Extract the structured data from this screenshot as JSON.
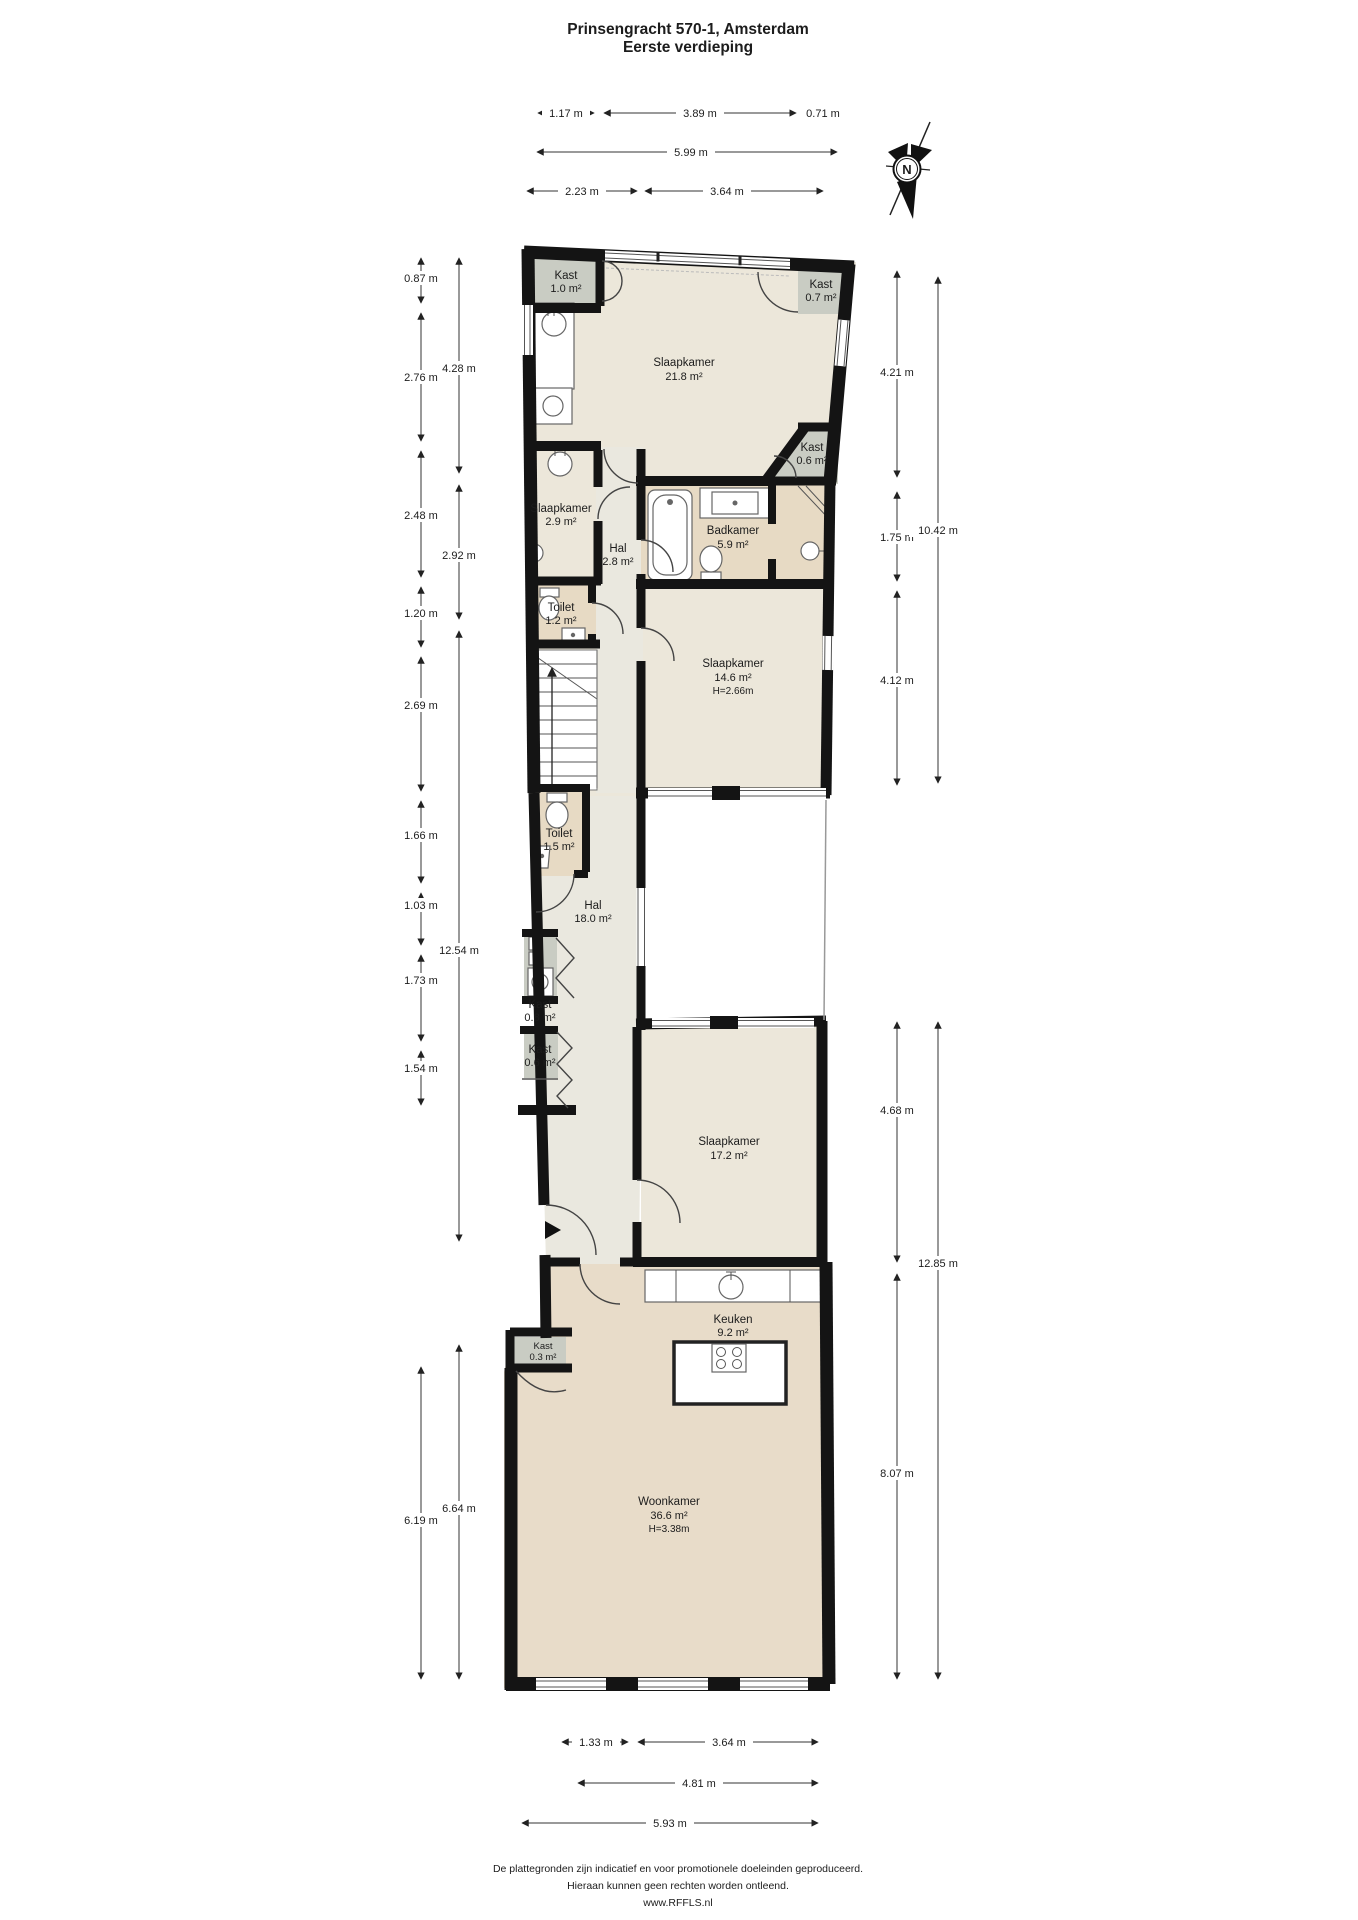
{
  "header": {
    "title_line1": "Prinsengracht 570-1, Amsterdam",
    "title_line2": "Eerste verdieping"
  },
  "compass": {
    "label": "N"
  },
  "rooms": [
    {
      "name": "Kast",
      "area": "1.0 m²"
    },
    {
      "name": "Slaapkamer",
      "area": "21.8 m²"
    },
    {
      "name": "Kast",
      "area": "0.7 m²"
    },
    {
      "name": "Kast",
      "area": "0.6 m²"
    },
    {
      "name": "Slaapkamer",
      "area": "2.9 m²"
    },
    {
      "name": "Hal",
      "area": "2.8 m²"
    },
    {
      "name": "Badkamer",
      "area": "5.9 m²"
    },
    {
      "name": "Toilet",
      "area": "1.2 m²"
    },
    {
      "name": "Slaapkamer",
      "area": "14.6 m²",
      "height": "H=2.66m"
    },
    {
      "name": "Toilet",
      "area": "1.5 m²"
    },
    {
      "name": "Hal",
      "area": "18.0 m²"
    },
    {
      "name": "Kast",
      "area": "0.8 m²"
    },
    {
      "name": "Kast",
      "area": "0.6 m²"
    },
    {
      "name": "Slaapkamer",
      "area": "17.2 m²"
    },
    {
      "name": "Keuken",
      "area": "9.2 m²"
    },
    {
      "name": "Kast",
      "area": "0.3 m²"
    },
    {
      "name": "Woonkamer",
      "area": "36.6 m²",
      "height": "H=3.38m"
    }
  ],
  "dimensions": {
    "top": [
      "1.17 m",
      "3.89 m",
      "0.71 m",
      "5.99 m",
      "2.23 m",
      "3.64 m"
    ],
    "left_outer": [
      "0.87 m",
      "2.76 m",
      "2.48 m",
      "1.20 m",
      "2.69 m",
      "1.66 m",
      "1.03 m",
      "1.73 m",
      "1.54 m",
      "6.19 m"
    ],
    "left_inner": [
      "4.28 m",
      "2.92 m",
      "12.54 m",
      "6.64 m"
    ],
    "right_inner": [
      "4.21 m",
      "1.75 m",
      "4.12 m",
      "4.68 m",
      "8.07 m"
    ],
    "right_outer": [
      "10.42 m",
      "12.85 m"
    ],
    "bottom": [
      "1.33 m",
      "3.64 m",
      "4.81 m",
      "5.93 m"
    ]
  },
  "footer": {
    "line1": "De plattegronden zijn indicatief en voor promotionele doeleinden geproduceerd.",
    "line2": "Hieraan kunnen geen rechten worden ontleend.",
    "line3": "www.RFFLS.nl"
  },
  "colors": {
    "wall": "#141414",
    "bedroom": "#ece7da",
    "wet_room": "#e7dac4",
    "living": "#e8dcc9",
    "hall": "#eae8df",
    "closet": "#c9ccc3"
  }
}
